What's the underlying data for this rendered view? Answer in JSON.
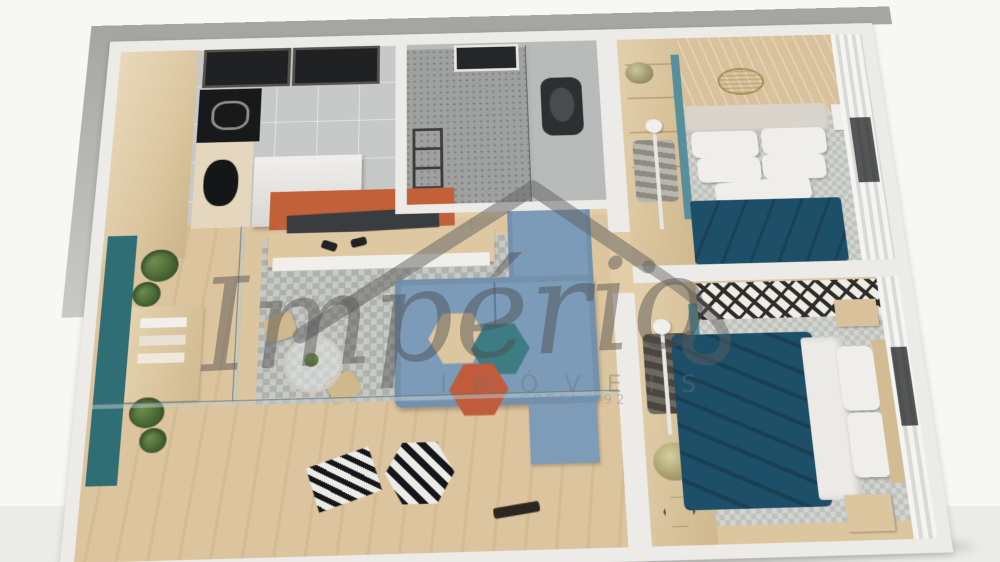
{
  "meta": {
    "type": "3d-floorplan-render",
    "view": "top-down-perspective"
  },
  "watermark": {
    "brand_script": "Império",
    "brand_sub": "IMÓVEIS",
    "registration": "CRECI | 92",
    "house_icon": "roof-outline-with-swoosh",
    "color": "#6a6a6a"
  },
  "headboard_stamp": {
    "shape": "oval",
    "style": "embossed gold outline, text illegible"
  },
  "palette": {
    "background": "#f7f7f5",
    "surface_band": "#ebebe8",
    "walls": "#edebe7",
    "outer_band": "#a5a5a3",
    "wood_floor": "#dcc6a0",
    "deck": "#d8c09a",
    "kitchen_tile": "#c7c9c8",
    "bath_floor": "#9fa1a0",
    "rug_gray": "#b5b8b3",
    "duvet_teal": "#1e4f68",
    "sofa_blue": "#7b9bb8",
    "accent_orange": "#c2603a",
    "accent_teal": "#3d7c82",
    "planter_teal": "#2e6e74",
    "curtain_white": "#eeeeec"
  },
  "scene": {
    "rooms": [
      {
        "name": "kitchen",
        "items": [
          "tall-wood-cabinet",
          "dark-wall-windows",
          "cooktop",
          "sink",
          "counter",
          "island-counter",
          "tile-floor"
        ]
      },
      {
        "name": "bathroom",
        "items": [
          "window",
          "shower-glass",
          "speckled-shower-floor",
          "black-toilet",
          "ladder-towel-rack"
        ]
      },
      {
        "name": "living-room",
        "items": [
          "orange-tv-panel",
          "tv",
          "media-console",
          "game-controllers",
          "blue-sofa-with-chaise",
          "blue-ottoman",
          "hex-coffee-tables-tan-teal-orange",
          "diamond-gray-rug"
        ]
      },
      {
        "name": "dining-nook",
        "items": [
          "round-glass-table",
          "two-wood-chairs",
          "table-plant"
        ]
      },
      {
        "name": "balcony",
        "items": [
          "wood-deck",
          "teal-planter-box",
          "green-plants",
          "wood-shelf",
          "striped-hex-pouf",
          "striped-mat",
          "dark-remote"
        ]
      },
      {
        "name": "bedroom-1",
        "items": [
          "wood-headboard-wall",
          "oval-stamp",
          "closet-shelves-teal-divider",
          "floor-lamp",
          "double-bed",
          "white-pillows",
          "teal-duvet",
          "checkered-rug",
          "white-nightstand",
          "curtain-wall",
          "window"
        ]
      },
      {
        "name": "bedroom-2",
        "items": [
          "bw-runner-rug",
          "closet-shelves-teal-divider",
          "floor-lamp",
          "dried-plant",
          "hexagon-wire-decor",
          "double-bed",
          "white-pillows",
          "teal-duvet",
          "checkered-rug",
          "wood-nightstands",
          "curtain-wall",
          "window"
        ]
      }
    ]
  }
}
